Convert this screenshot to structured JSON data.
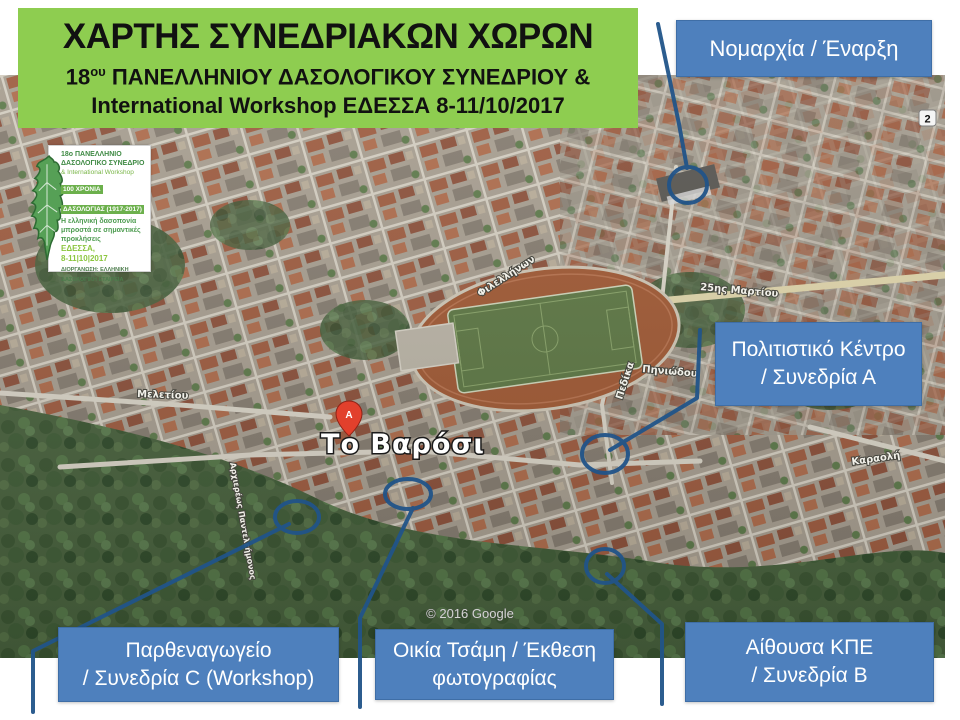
{
  "slide": {
    "title_line1": "ΧΑΡΤΗΣ ΣΥΝΕΔΡΙΑΚΩΝ ΧΩΡΩΝ",
    "subtitle_prefix": "18",
    "subtitle_sup": "ου",
    "subtitle_rest": " ΠΑΝΕΛΛΗΝΙΟΥ ΔΑΣΟΛΟΓΙΚΟΥ ΣΥΝΕΔΡΙΟΥ &",
    "subtitle_line2": "International Workshop ΕΔΕΣΣΑ 8-11/10/2017"
  },
  "logo": {
    "line1": "18ο ΠΑΝΕΛΛΗΝΙΟ",
    "line2": "ΔΑΣΟΛΟΓΙΚΟ ΣΥΝΕΔΡΙΟ",
    "line3": "& International Workshop",
    "banner1": "100 ΧΡΟΝΙΑ",
    "banner2": "ΔΑΣΟΛΟΓΙΑΣ (1917-2017)",
    "motto1": "Η ελληνική δασοπονία",
    "motto2": "μπροστά σε σημαντικές",
    "motto3": "προκλήσεις",
    "place": "ΕΔΕΣΣΑ,",
    "dates": "8-11|10|2017",
    "org1": "ΔΙΟΡΓΑΝΩΣΗ: ΕΛΛΗΝΙΚΗ",
    "org2": "ΔΑΣΟΛΟΓΙΚΗ ΕΤΑΙΡΕΙΑ"
  },
  "callouts": [
    {
      "id": "nomarchia",
      "line1": "Νομαρχία / Έναρξη",
      "line2": ""
    },
    {
      "id": "politistiko",
      "line1": "Πολιτιστικό Κέντρο",
      "line2": "/ Συνεδρία Α"
    },
    {
      "id": "parthenagogeio",
      "line1": "Παρθεναγωγείο",
      "line2": "/ Συνεδρία C (Workshop)"
    },
    {
      "id": "oikia-tsami",
      "line1": "Οικία Τσάμη / Έκθεση",
      "line2": "φωτογραφίας"
    },
    {
      "id": "kpe",
      "line1": "Αίθουσα ΚΠΕ",
      "line2": "/ Συνεδρία Β"
    }
  ],
  "map": {
    "place_label": "Το Βαρόσι",
    "pin_letter": "A",
    "attribution": "© 2016 Google",
    "corner_badge": "2",
    "streets": [
      "Φιλελλήνων",
      "25ης Μαρτίου",
      "Πηνιώδου",
      "Πεδίκα",
      "Καραολή",
      "Μελετίου",
      "Αρχιερέως Παντελεήμονος"
    ]
  },
  "colors": {
    "title_bg": "#8ECD50",
    "callout_bg": "#4E80BD",
    "callout_border": "#3F6EA6",
    "connector": "#215489"
  }
}
